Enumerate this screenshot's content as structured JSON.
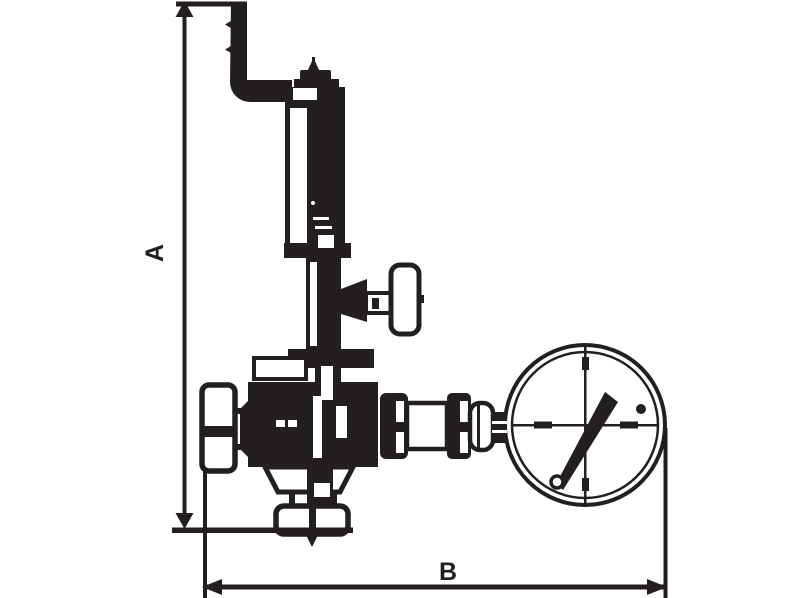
{
  "diagram": {
    "type": "technical-line-drawing",
    "subject": "Pressure reducing valve with spring bonnet, relief elbow pipe, shut-off T-handle and pressure gauge - dimensional outline drawing",
    "colors": {
      "line": "#231f20",
      "background": "#ffffff"
    },
    "dimensions": {
      "height_label": "A",
      "width_label": "B"
    }
  }
}
